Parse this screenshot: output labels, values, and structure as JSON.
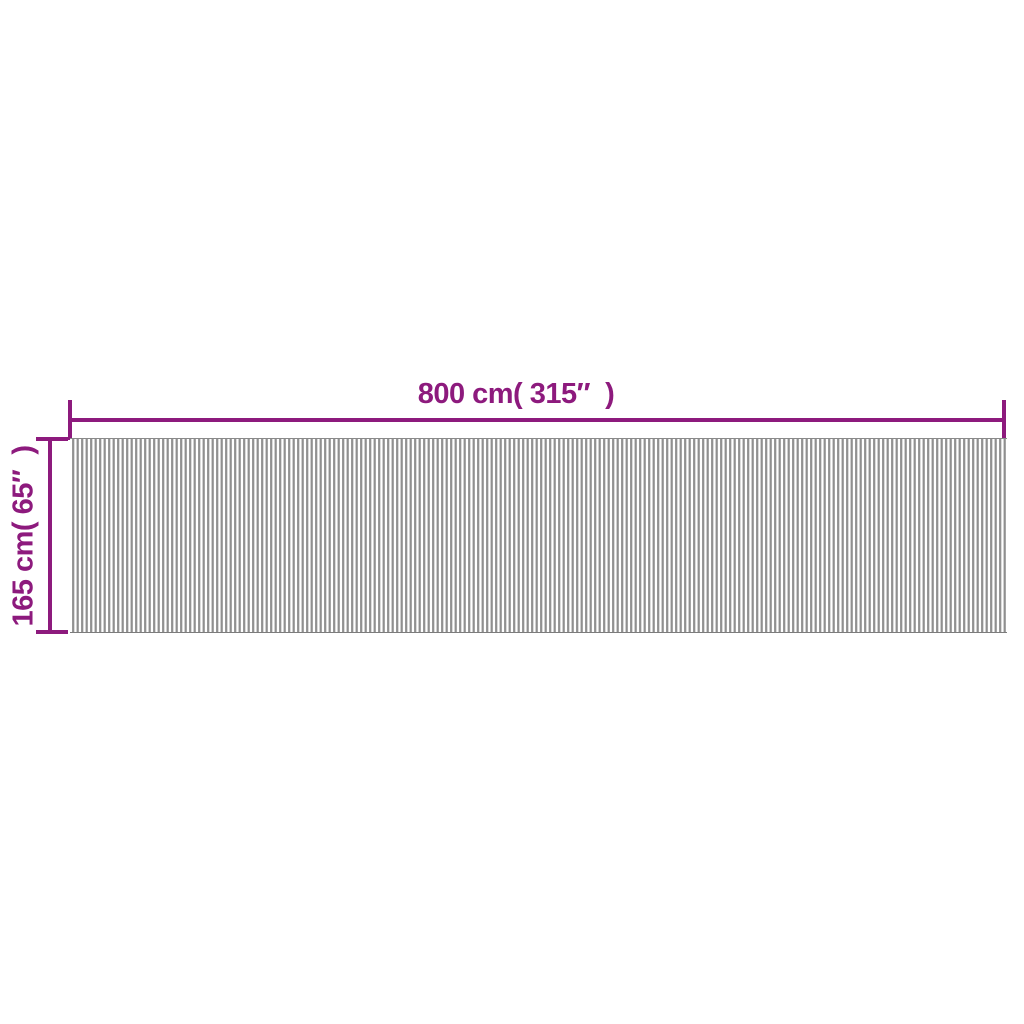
{
  "diagram": {
    "width_label": "800 cm( 315″  )",
    "height_label": "165 cm( 65″  )"
  },
  "colors": {
    "accent": "#8d1a7d",
    "stripe_light": "#ffffff",
    "stripe_mid": "#c2c2c2",
    "stripe_dark": "#8f8f8f",
    "mat_border_top": "#8a8a8a",
    "mat_border_bottom": "#7c7c7c",
    "background": "#ffffff"
  }
}
